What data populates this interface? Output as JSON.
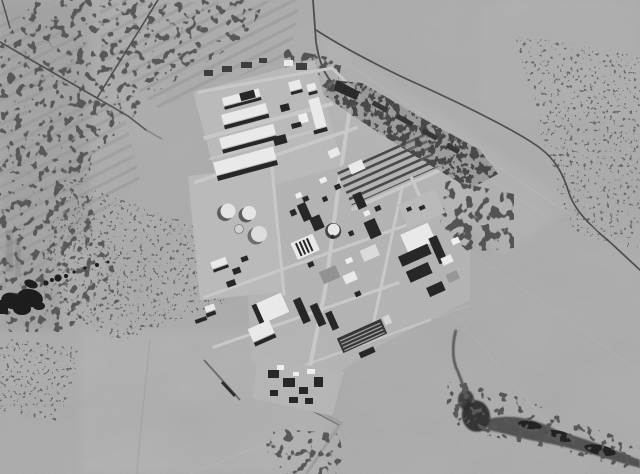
{
  "meta": {
    "description": "Black-and-white aerial satellite photograph of a fenced industrial research complex in open desert: a tilted grid of white-roofed and dark buildings with light streets, a tank farm with circular storage tanks, a small domed reactor building, rows of cultivated strips and dark scrub vegetation, dirt roads with a junction at upper left, a curving perimeter road on the right, and a dark dry wadi streambed at lower right.",
    "width": 640,
    "height": 474
  },
  "colors": {
    "desert": "#a9a9a9",
    "desert_light": "#b4b4b4",
    "pad": "#b9b9b9",
    "street": "#c9c9c9",
    "roof": "#ececec",
    "white": "#f2f2f2",
    "dark": "#1b1b1b",
    "mid": "#707070",
    "road": "#454545",
    "veg": "#151515",
    "wadi": "#242424"
  },
  "features": {
    "labels": [
      "desert-plain",
      "furrowed-field-rows",
      "scrub-vegetation-patches",
      "dirt-road-junction",
      "access-road",
      "perimeter-road",
      "industrial-complex",
      "northwest-building-cluster",
      "tank-farm",
      "reactor-dome",
      "greenhouse-strip-rows",
      "orchard-grove",
      "southern-building-cluster",
      "wadi-streambed"
    ]
  }
}
